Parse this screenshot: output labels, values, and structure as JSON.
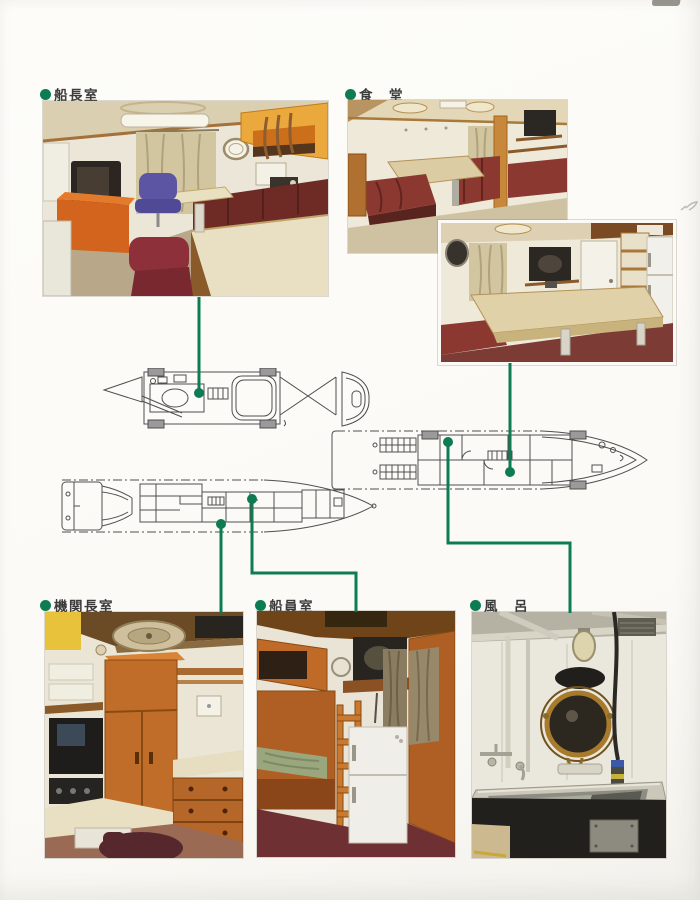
{
  "page": {
    "accent_green": "#0d7c52",
    "plan_line_color": "#4f4f4f",
    "background": "#fbfaf6"
  },
  "sections": {
    "captain_room": {
      "label": "船長室"
    },
    "dining_room": {
      "label": "食　堂"
    },
    "chief_engineer_room": {
      "label": "機関長室"
    },
    "crew_room": {
      "label": "船員室"
    },
    "bath": {
      "label": "風　呂"
    }
  }
}
